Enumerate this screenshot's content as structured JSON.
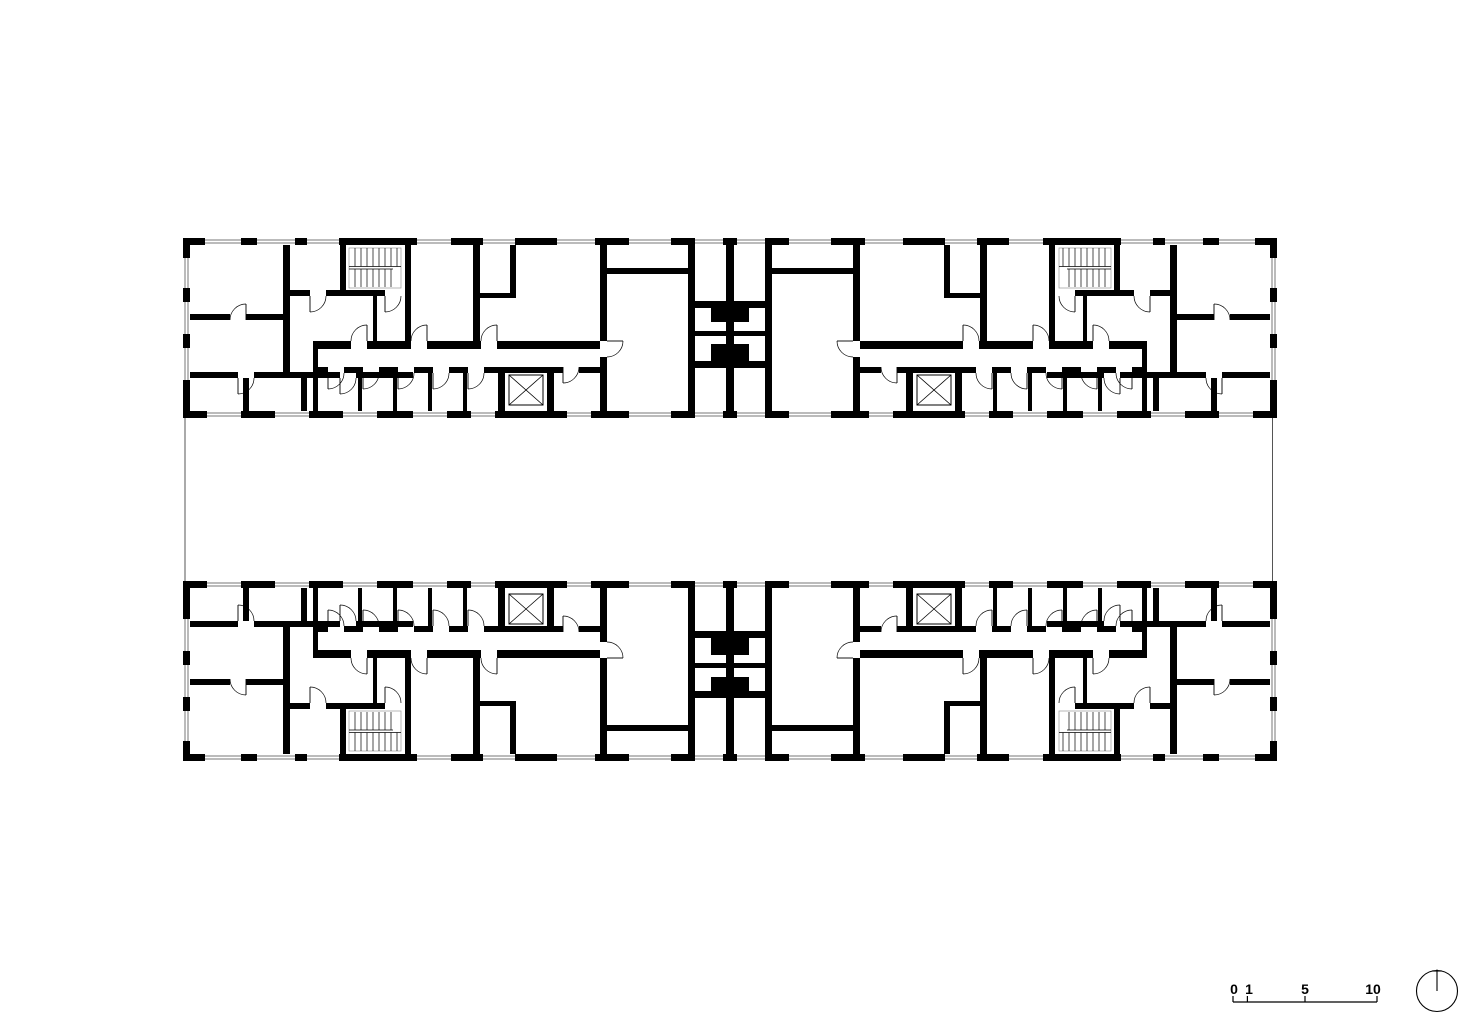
{
  "drawing": {
    "type": "architectural floor plan",
    "subject": "two parallel residential wings with stair cores, elevator shafts and courtyard between"
  },
  "scale_bar": {
    "labels": [
      "0",
      "1",
      "5",
      "10"
    ]
  },
  "north_arrow": {
    "direction": "up"
  },
  "colors": {
    "ink": "#000000",
    "paper": "#ffffff",
    "glazing": "#777777",
    "courtyard_line": "#555555"
  }
}
